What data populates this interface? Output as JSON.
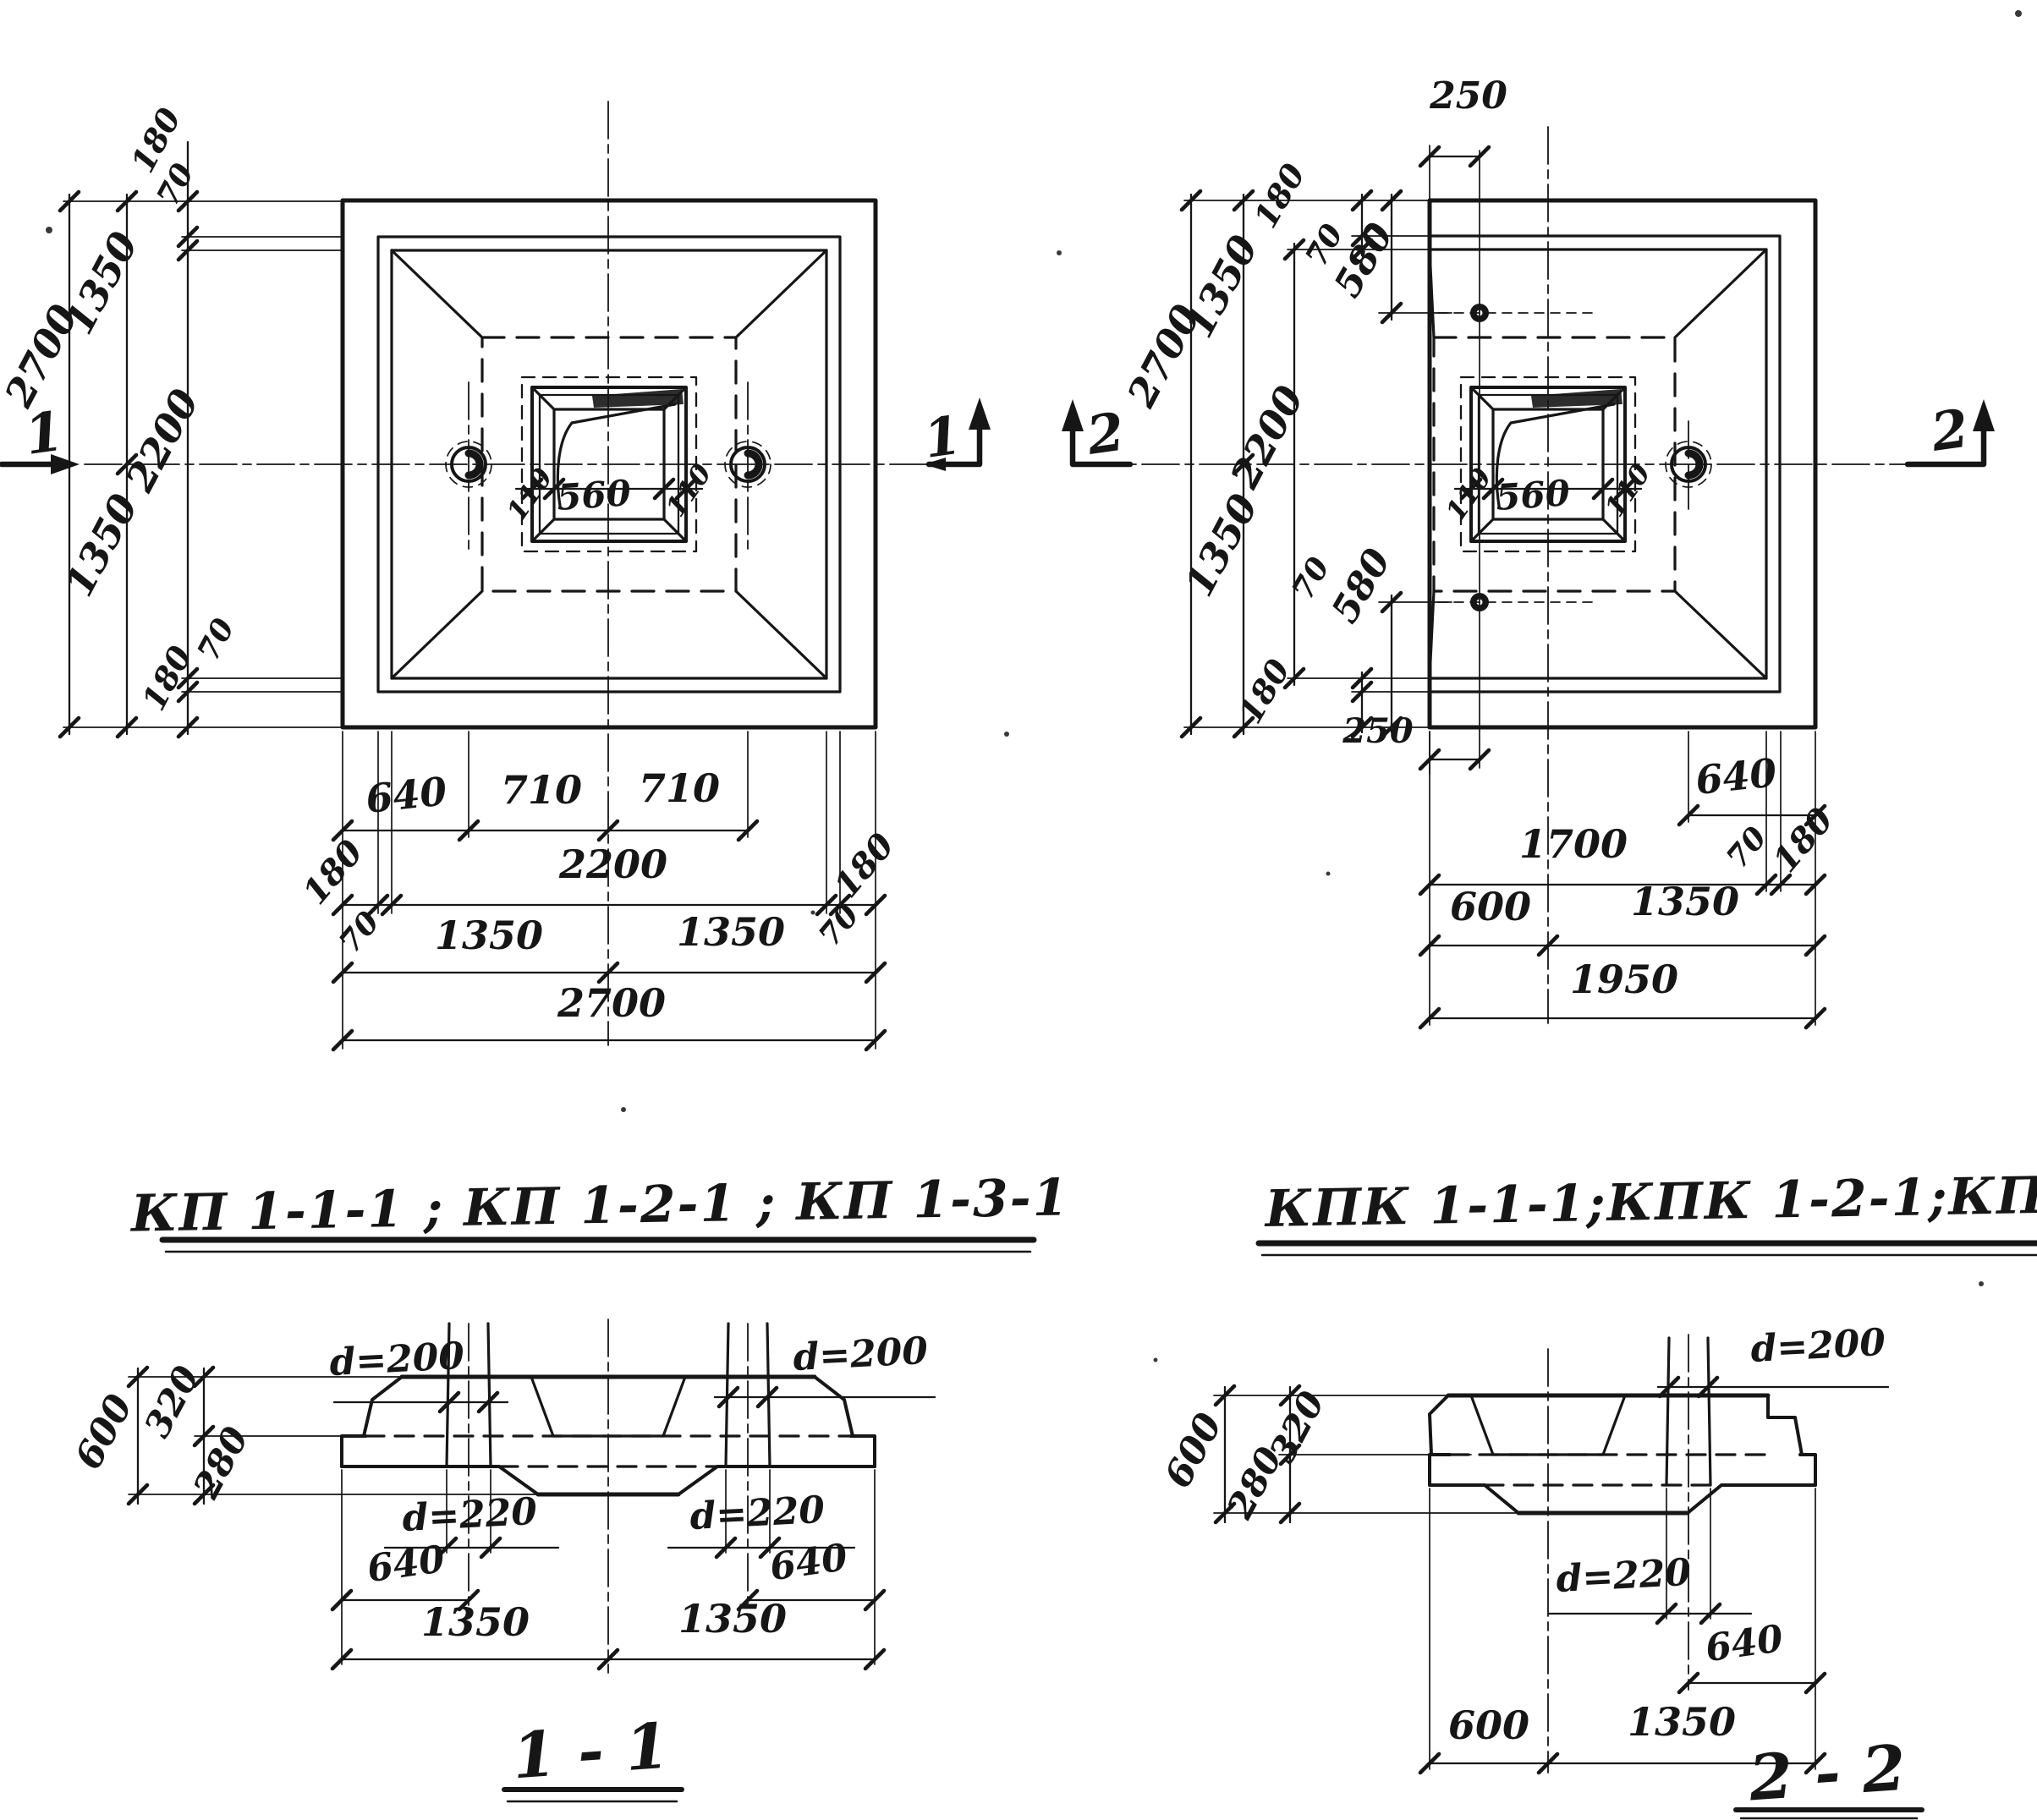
{
  "canvas": {
    "bg": "#ffffff",
    "ink": "#161616"
  },
  "plan_kp": {
    "title": "КП 1-1-1 ; КП 1-2-1 ; КП 1-3-1",
    "mark": "1",
    "dims": {
      "total_v": "2700",
      "half_top": "1350",
      "half_bot": "1350",
      "inner_v": "2200",
      "edge_top": "180",
      "step_top": "70",
      "step_bot": "70",
      "edge_bot": "180",
      "socket_l": "110",
      "socket": "560",
      "socket_r": "110",
      "hole": "640",
      "pitch_l": "710",
      "pitch_r": "710",
      "edge_l": "180",
      "inner_h": "2200",
      "edge_r": "180",
      "step_l": "70",
      "step_r": "70",
      "half_l": "1350",
      "half_r": "1350",
      "total_h": "2700"
    }
  },
  "plan_kpk": {
    "title": "КПК 1-1-1;КПК 1-2-1;КПК 1-3-1",
    "mark": "2",
    "dims": {
      "total_v": "2700",
      "half_top": "1350",
      "half_bot": "1350",
      "inner_v": "2200",
      "edge_top": "180",
      "step_top": "70",
      "hole_top": "580",
      "edge_bot": "180",
      "step_bot": "70",
      "hole_bot": "580",
      "off_top": "250",
      "off_bot": "250",
      "socket_l": "110",
      "socket": "560",
      "socket_r": "110",
      "hole": "640",
      "span": "1700",
      "step_r": "70",
      "edge_r": "180",
      "socket_off": "600",
      "half_r": "1350",
      "total_h": "1950"
    }
  },
  "section_11": {
    "title": "1 - 1",
    "dims": {
      "d_top_l": "d=200",
      "d_top_r": "d=200",
      "d_bot_l": "d=220",
      "d_bot_r": "d=220",
      "h_total": "600",
      "h_top": "320",
      "h_bot": "280",
      "hole_l": "640",
      "hole_r": "640",
      "half_l": "1350",
      "half_r": "1350"
    }
  },
  "section_22": {
    "title": "2 - 2",
    "dims": {
      "d_top": "d=200",
      "d_bot": "d=220",
      "h_total": "600",
      "h_top": "320",
      "h_bot": "280",
      "hole": "640",
      "socket_off": "600",
      "half": "1350"
    }
  }
}
